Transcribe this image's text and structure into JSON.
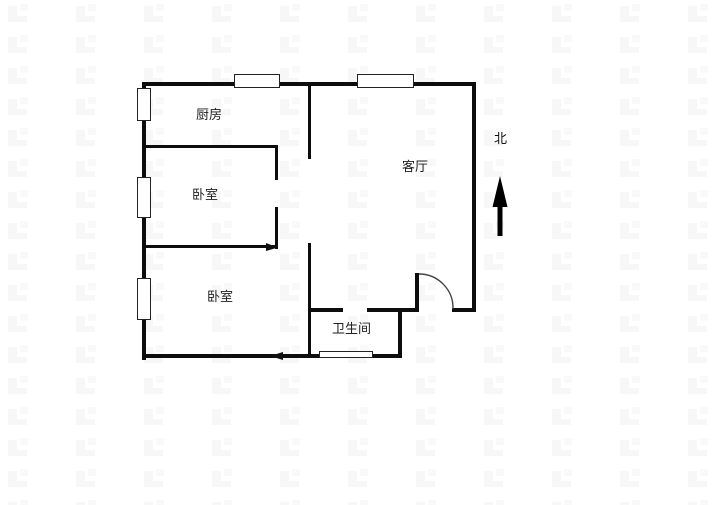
{
  "canvas": {
    "width": 720,
    "height": 505,
    "background": "#ffffff"
  },
  "colors": {
    "wall": "#0d0d0d",
    "window_border": "#222222",
    "window_fill": "#ffffff",
    "door_arc": "#444444",
    "label_text": "#1f1f1f",
    "north_arrow": "#000000",
    "watermark": "#f7f7f7"
  },
  "rooms": [
    {
      "id": "kitchen",
      "label": "厨房"
    },
    {
      "id": "bedroom-1",
      "label": "卧室"
    },
    {
      "id": "living-room",
      "label": "客厅"
    },
    {
      "id": "bedroom-2",
      "label": "卧室"
    },
    {
      "id": "bathroom",
      "label": "卫生间"
    }
  ],
  "compass": {
    "label": "北",
    "direction": "up"
  }
}
